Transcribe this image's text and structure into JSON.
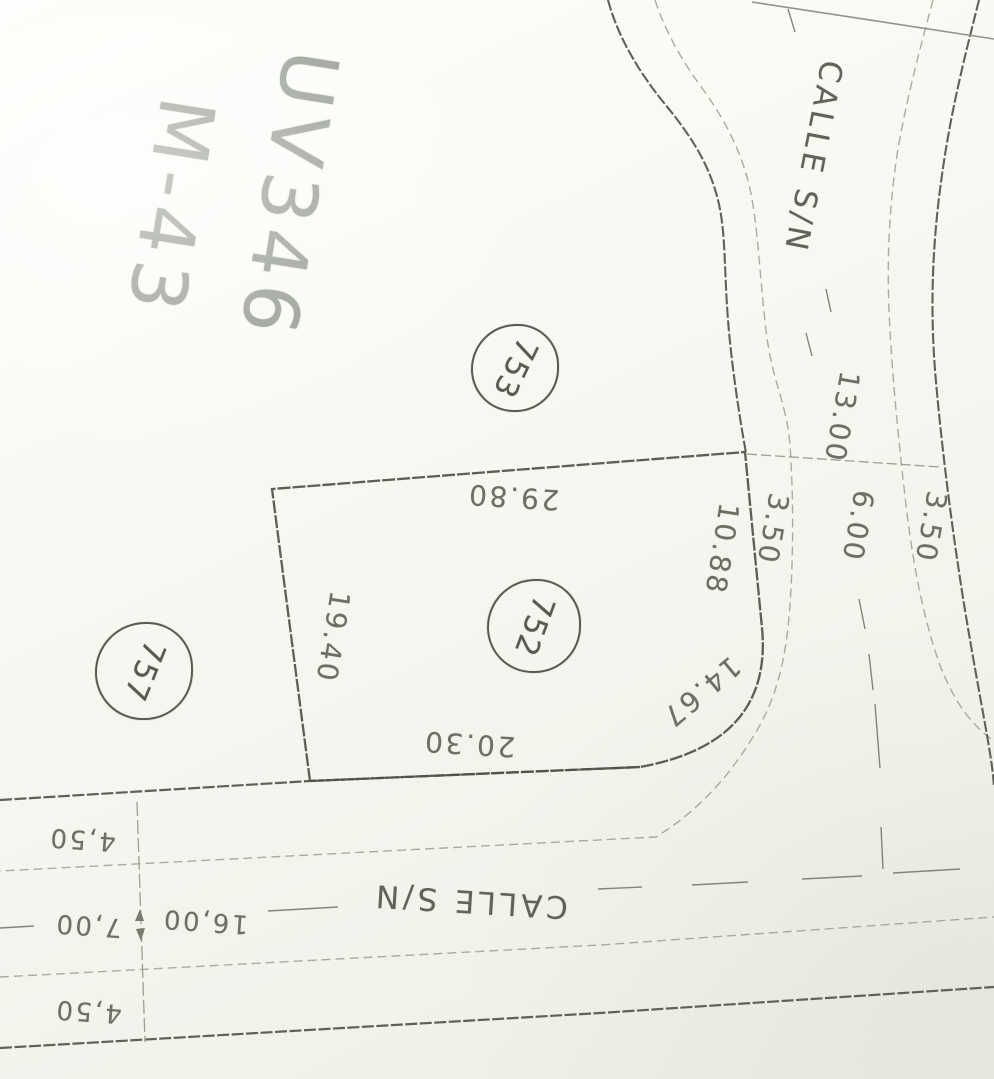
{
  "labels": {
    "block_line1": "UV346",
    "block_line2": "M-43",
    "street_top_name": "CALLE S/N",
    "street_bottom_name": "CALLE S/N",
    "lot_753": "753",
    "lot_752": "752",
    "lot_757": "757",
    "dim_top_edge": "29.80",
    "dim_left_edge": "19.40",
    "dim_bottom_edge": "20.30",
    "dim_corner_arc": "14.67",
    "dim_right_edge": "10.88",
    "street_top_sidewalk_left": "3.50",
    "street_top_total": "13.00",
    "street_top_road": "6.00",
    "street_top_sidewalk_right": "3.50",
    "street_bottom_sidewalk_north": "4,50",
    "street_bottom_road": "7,00",
    "street_bottom_total": "16,00",
    "street_bottom_sidewalk_south": "4,50"
  },
  "colors": {
    "paper": "#f7f7f1",
    "line_dark": "#4d5147",
    "line_light": "#a8ad9d",
    "centerline": "#82877a",
    "pencil_text": "#90968b",
    "dim_text": "#6b7062"
  }
}
